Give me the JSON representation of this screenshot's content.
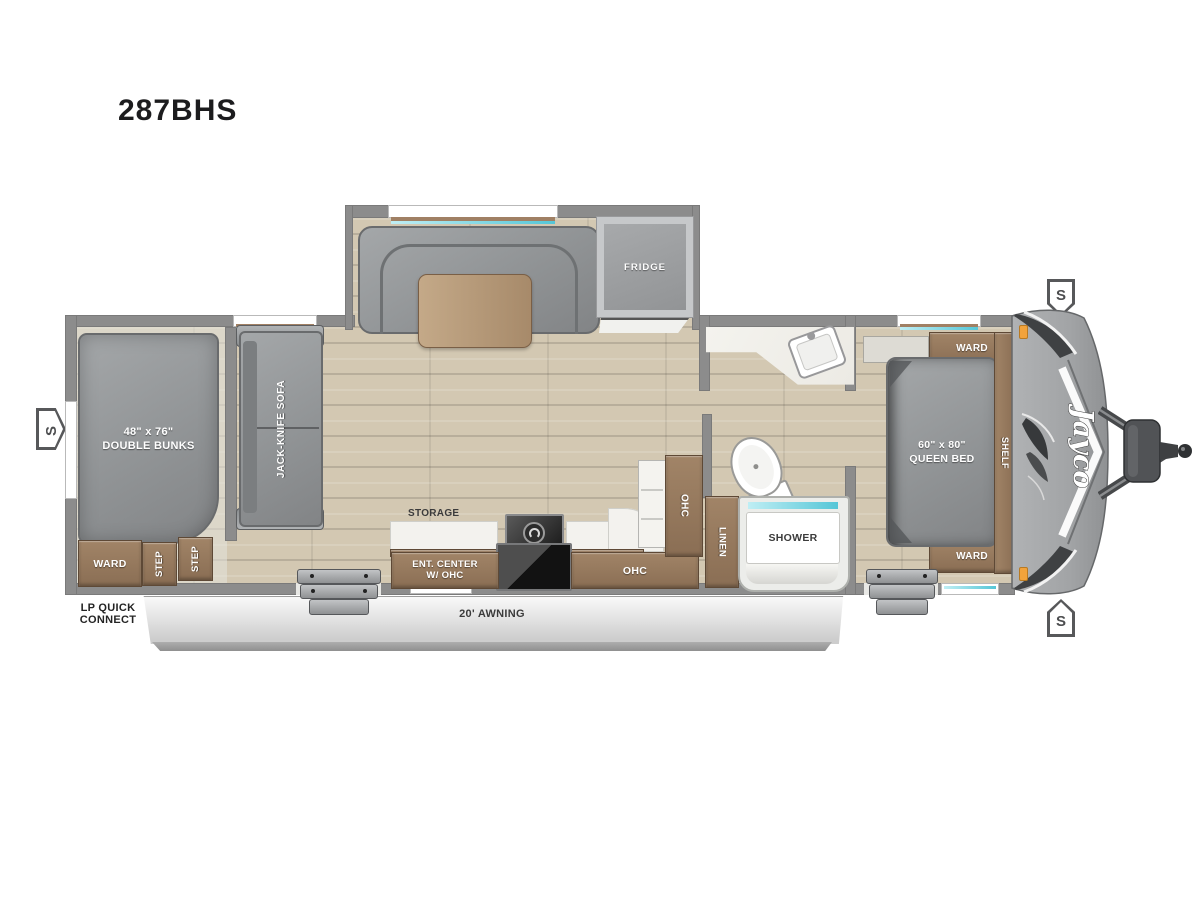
{
  "title": "287BHS",
  "floorplan": {
    "slideout": {
      "fridge": "FRIDGE"
    },
    "bunk_area": {
      "bunks_size": "48\" x 76\"",
      "bunks_name": "DOUBLE BUNKS",
      "ward": "WARD",
      "step_front": "STEP",
      "step_rear": "STEP"
    },
    "living_kitchen": {
      "sofa": "JACK-KNIFE SOFA",
      "storage": "STORAGE",
      "ent_center_line1": "ENT. CENTER",
      "ent_center_line2": "W/ OHC",
      "ohc_lower": "OHC",
      "ohc_upper": "OHC"
    },
    "bathroom": {
      "linen": "LINEN",
      "shower": "SHOWER"
    },
    "bedroom": {
      "bed_size": "60\" x 80\"",
      "bed_name": "QUEEN BED",
      "ward_front": "WARD",
      "ward_rear": "WARD",
      "shelf": "SHELF"
    },
    "exterior": {
      "brand_logo": "Jayco",
      "awning": "20' AWNING",
      "lp_line1": "LP QUICK",
      "lp_line2": "CONNECT",
      "speaker": "S"
    }
  },
  "colors": {
    "wall": "#8c8c8c",
    "wood_cabinet": "#8f745a",
    "floor_wood": "#d3c8b2",
    "furniture_gray": "#97999c",
    "window_accent": "#55c6d7",
    "marker_light": "#f2a33c",
    "front_cap": "#a4a6a8",
    "awning": "#d9d9d9"
  }
}
